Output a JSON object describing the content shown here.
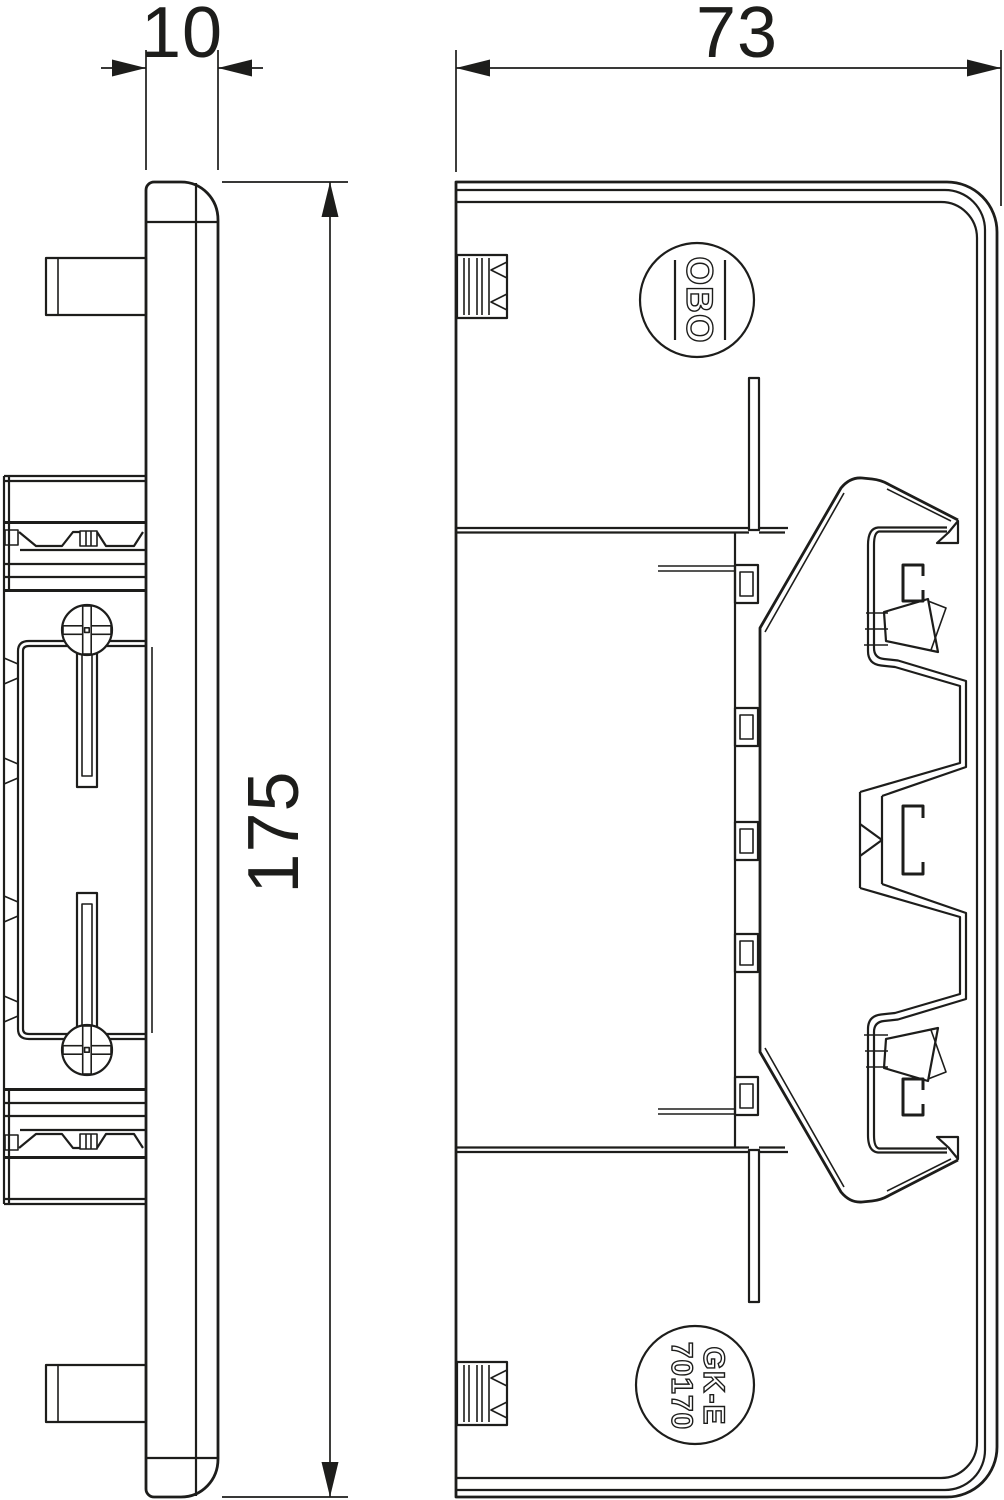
{
  "drawing": {
    "title": "Technical drawing - end piece",
    "views": {
      "side_view": "side profile view",
      "front_view": "front view"
    }
  },
  "dimensions": {
    "depth": {
      "label": "10"
    },
    "width": {
      "label": "73"
    },
    "height": {
      "label": "175"
    }
  },
  "markings": {
    "logo_text": "OBO",
    "part_series": "GK-E",
    "part_number": "70170"
  },
  "colors": {
    "line": "#1d1d1b",
    "background": "#ffffff"
  }
}
